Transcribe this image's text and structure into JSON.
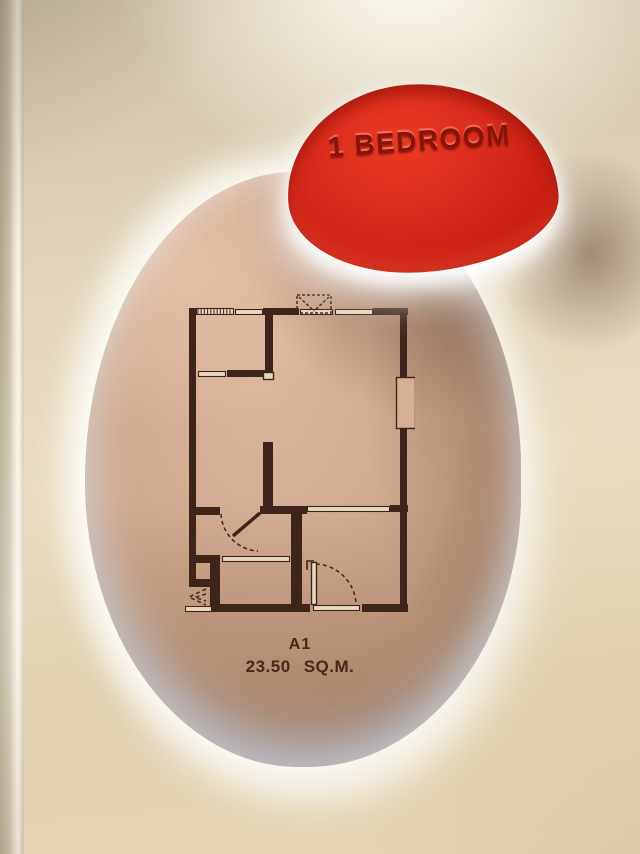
{
  "sign": {
    "label": "1 BEDROOM"
  },
  "unit": {
    "name": "A1",
    "area_value": "23.50",
    "area_unit": "SQ.M."
  },
  "colors": {
    "sign_red": "#d7291b",
    "sign_text": "#8c1207",
    "plan_line": "#3e251c",
    "plan_window_fill": "#e8d8c2",
    "plan_frame_fill": "#d6b096",
    "niche_top": "#d9b59c",
    "niche_mid": "#cda78b",
    "niche_bottom": "#9e7455",
    "label_color": "#4b241a"
  },
  "floorplan": {
    "viewbox": "0 0 230 334",
    "walls": [
      [
        4,
        23,
        7,
        279
      ],
      [
        78,
        23,
        36,
        7
      ],
      [
        188,
        23,
        35,
        7
      ],
      [
        215,
        30,
        7,
        62
      ],
      [
        215,
        144,
        7,
        183
      ],
      [
        80,
        30,
        8,
        57
      ],
      [
        42,
        85,
        38,
        7
      ],
      [
        78,
        157,
        10,
        66
      ],
      [
        11,
        222,
        24,
        8
      ],
      [
        75,
        221,
        47,
        8
      ],
      [
        205,
        220,
        18,
        7
      ],
      [
        106,
        229,
        11,
        98
      ],
      [
        11,
        270,
        24,
        8
      ],
      [
        4,
        294,
        24,
        8
      ],
      [
        25,
        278,
        10,
        49
      ],
      [
        28,
        319,
        97,
        8
      ],
      [
        177,
        319,
        46,
        8
      ]
    ],
    "windows": [
      [
        50,
        24,
        28,
        6
      ],
      [
        115,
        24,
        33,
        6
      ],
      [
        150,
        24,
        38,
        6
      ],
      [
        13,
        86,
        28,
        6
      ],
      [
        122,
        221,
        83,
        6
      ],
      [
        37,
        271,
        68,
        6
      ],
      [
        128,
        320,
        47,
        6
      ],
      [
        0,
        321,
        27,
        6
      ]
    ],
    "hatch": {
      "rect": [
        11,
        23,
        38,
        7
      ],
      "step": 3.2
    },
    "outline_boxes": [
      [
        211,
        92,
        20,
        52
      ],
      [
        78,
        87,
        11,
        8
      ],
      [
        126,
        277,
        6,
        43
      ]
    ],
    "dashed_boxes": [
      [
        112,
        10,
        34,
        18
      ]
    ],
    "thick_lines": [
      [
        75,
        228,
        48,
        251
      ]
    ],
    "dashed_lines": [
      [
        114,
        12,
        129,
        26
      ],
      [
        144,
        12,
        129,
        26
      ]
    ],
    "dashed_paths": [
      "M36,229 A39,39 0 0 0 73,266",
      "M131,279 A42,42 0 0 1 171,318",
      "M21,304 L4,312 L21,320",
      "M21,309 L10,312.5 L21,316"
    ],
    "solid_paths": [
      "M122,285 L122,276 L129,276"
    ]
  }
}
